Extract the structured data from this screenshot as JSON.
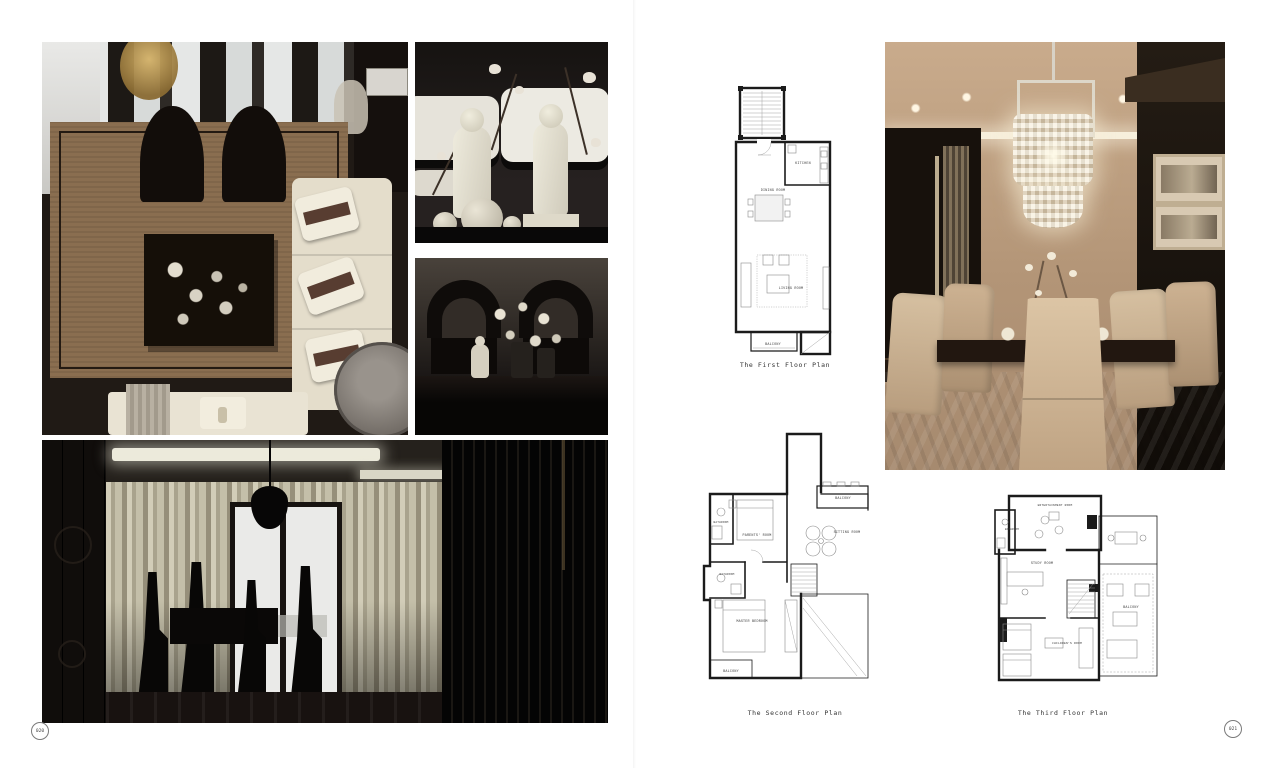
{
  "book": {
    "left_page_number": "020",
    "right_page_number": "021"
  },
  "plans": {
    "first": {
      "caption": "The First Floor Plan",
      "rooms": {
        "kitchen": "KITCHEN",
        "dining": "DINING ROOM",
        "living": "LIVING ROOM",
        "balcony": "BALCONY"
      }
    },
    "second": {
      "caption": "The Second Floor Plan",
      "rooms": {
        "balcony_top": "BALCONY",
        "bathroom_left": "BATHROOM",
        "parents": "PARENTS' ROOM",
        "sitting": "SITTING ROOM",
        "bathroom_mid": "BATHROOM",
        "master": "MASTER BEDROOM",
        "balcony_bottom": "BALCONY"
      }
    },
    "third": {
      "caption": "The Third Floor Plan",
      "rooms": {
        "entertainment": "ENTERTAINMENT ROOM",
        "bathroom": "BATHROOM",
        "study": "STUDY ROOM",
        "children": "CHILDREN'S ROOM",
        "balcony": "BALCONY"
      }
    }
  }
}
